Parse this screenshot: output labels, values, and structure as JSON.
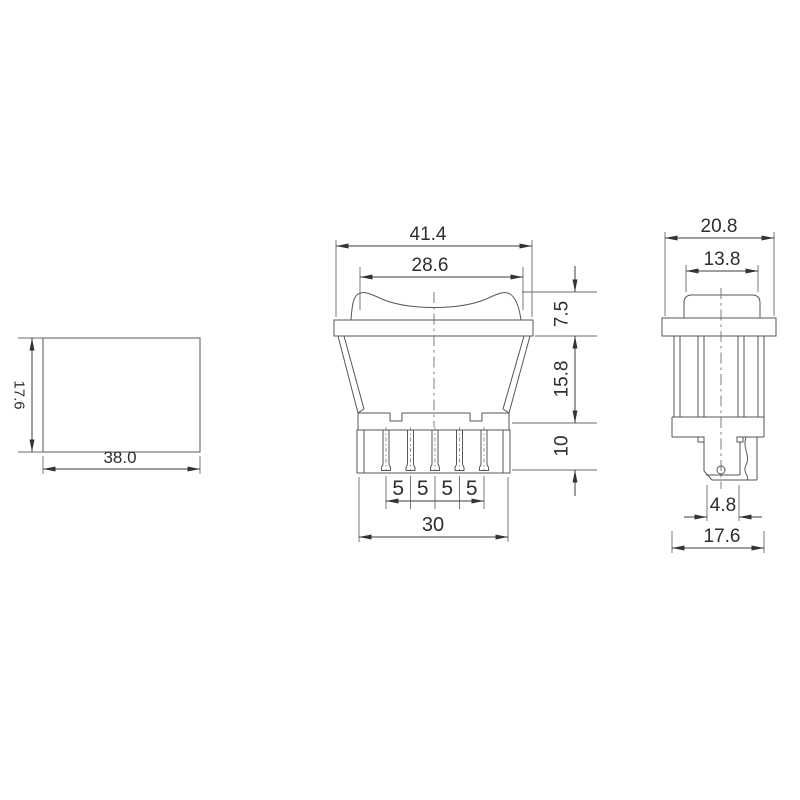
{
  "drawing": {
    "type": "rocker-switch-dimension-drawing",
    "background": "#ffffff",
    "line_color": "#565656",
    "text_color": "#2e2e2e"
  },
  "views": {
    "panel_cutout": {
      "height": "17.6",
      "width": "38.0"
    },
    "front": {
      "overall_width": "41.4",
      "rocker_width": "28.6",
      "bezel_height": "7.5",
      "body_height": "15.8",
      "terminal_height": "10",
      "pin_pitch": [
        "5",
        "5",
        "5",
        "5"
      ],
      "terminal_span": "30"
    },
    "side": {
      "overall_width": "20.8",
      "rocker_width": "13.8",
      "terminal_width": "4.8",
      "body_width": "17.6"
    }
  }
}
